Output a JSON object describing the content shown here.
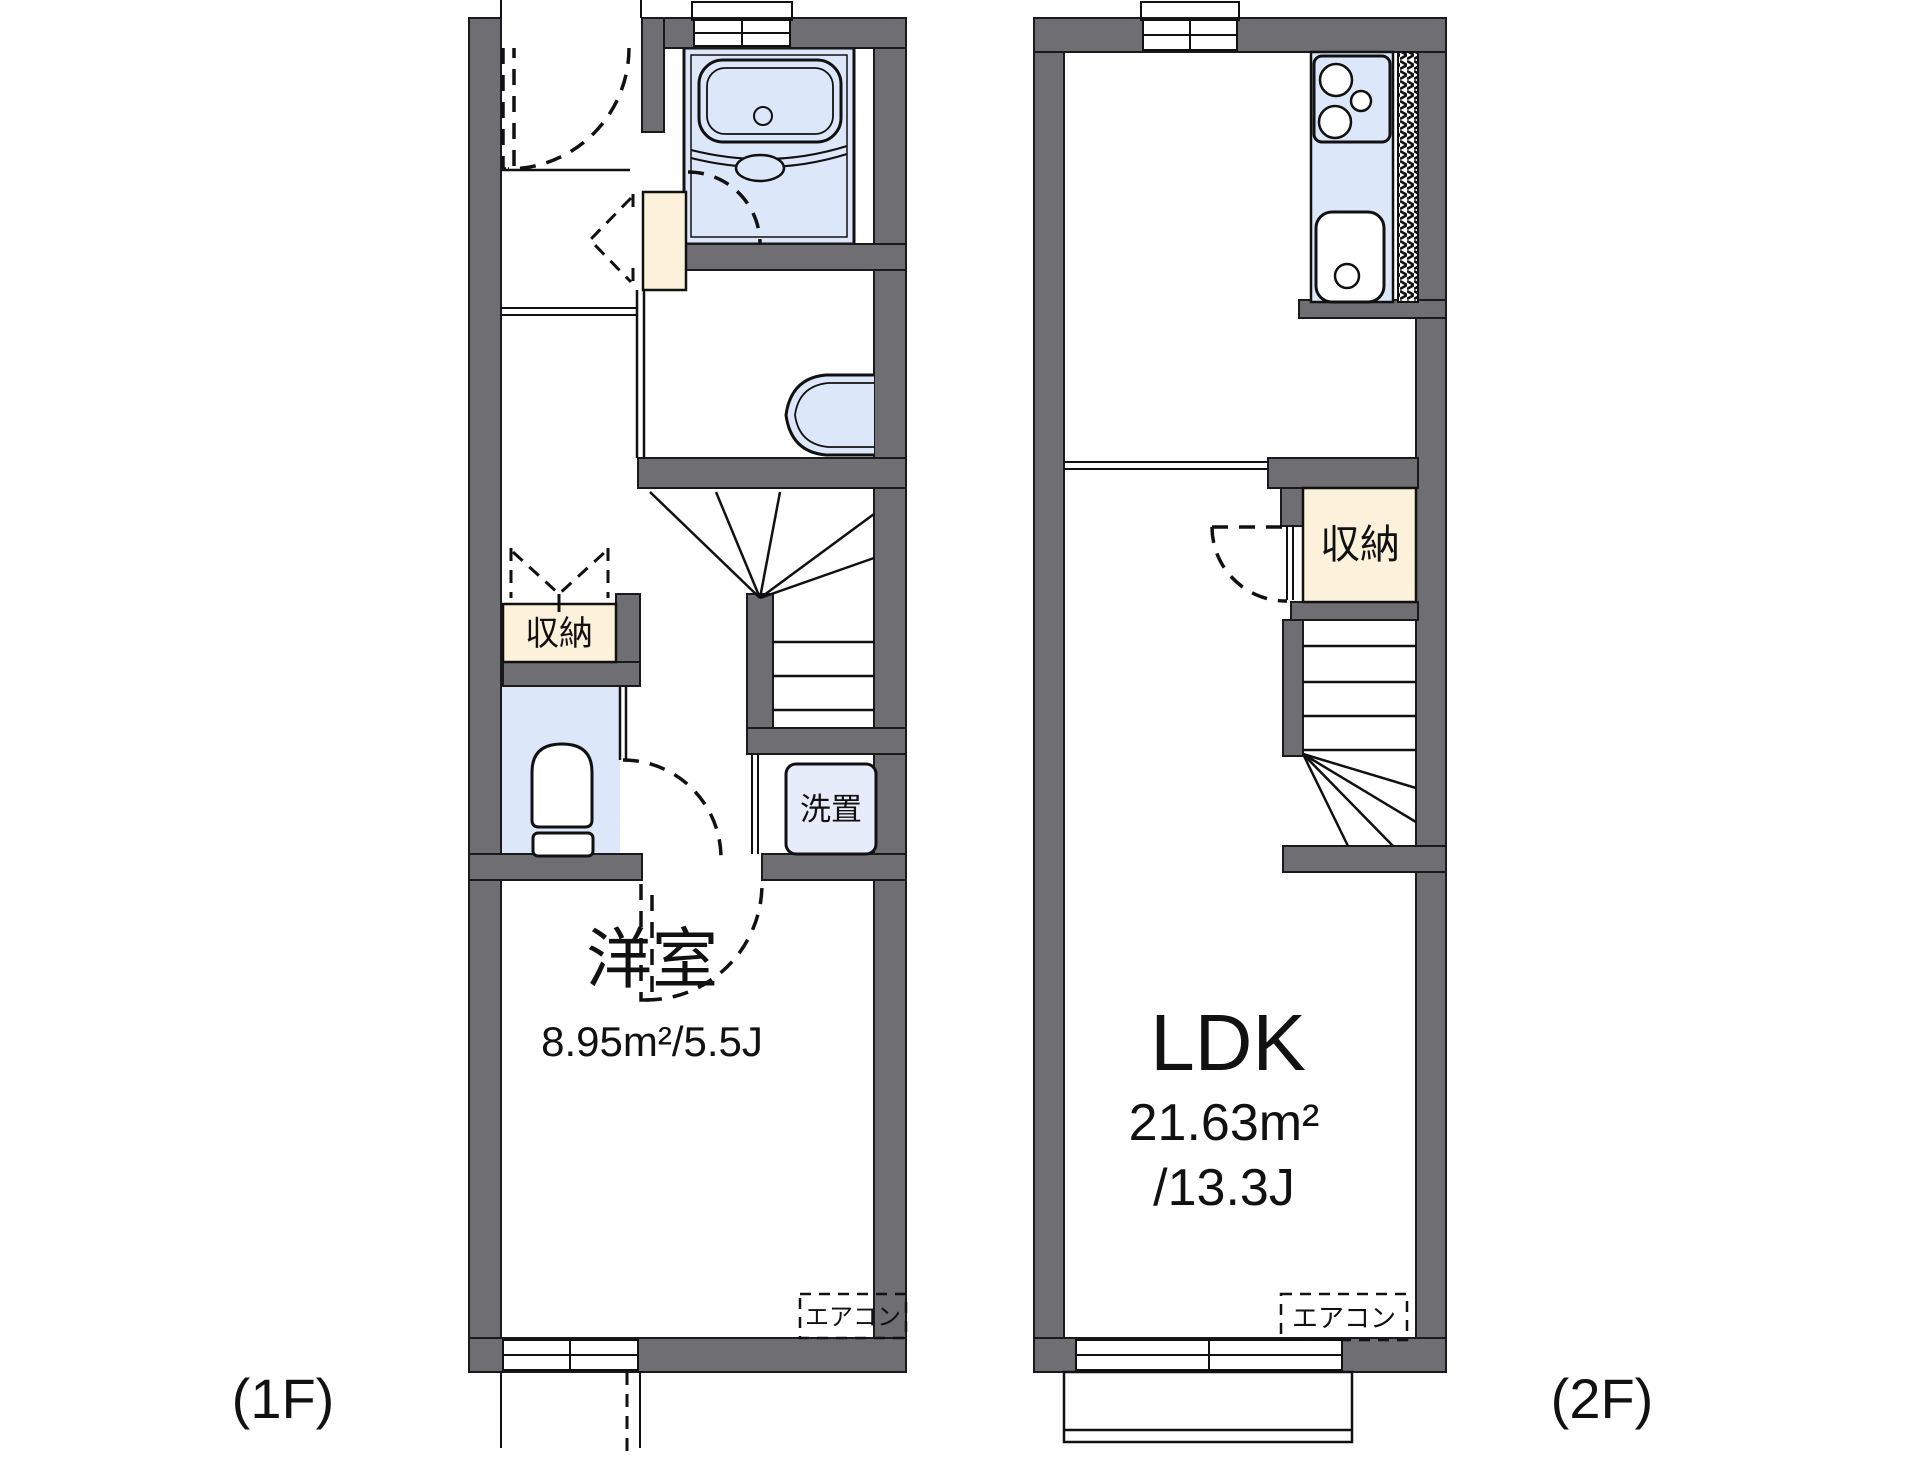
{
  "document": {
    "type": "apartment-floor-plan",
    "floors": [
      "1F",
      "2F"
    ]
  },
  "colors": {
    "wall_gray": "#6e6e73",
    "water_blue": "#dce8f9",
    "appliance_blue": "#e6ecf9",
    "storage_cream": "#fcf2dc",
    "line_black": "#111111",
    "background": "#ffffff"
  },
  "floor1": {
    "floor_label": "(1F)",
    "room": {
      "label": "洋室",
      "area": "8.95m²/5.5J"
    },
    "storage": {
      "label": "収納"
    },
    "laundry": {
      "label": "洗置"
    },
    "aircon": {
      "label": "エアコン"
    },
    "fixtures": [
      "entrance-door",
      "shoe-cabinet",
      "unit-bath-with-tub",
      "washbasin",
      "toilet",
      "winding-staircase",
      "washing-machine-space"
    ]
  },
  "floor2": {
    "floor_label": "(2F)",
    "room": {
      "label": "LDK",
      "area_m2": "21.63m²",
      "area_jo": "/13.3J"
    },
    "storage": {
      "label": "収納"
    },
    "aircon": {
      "label": "エアコン"
    },
    "fixtures": [
      "kitchen-counter",
      "stove",
      "sink",
      "storage-closet",
      "winding-staircase",
      "balcony"
    ]
  }
}
